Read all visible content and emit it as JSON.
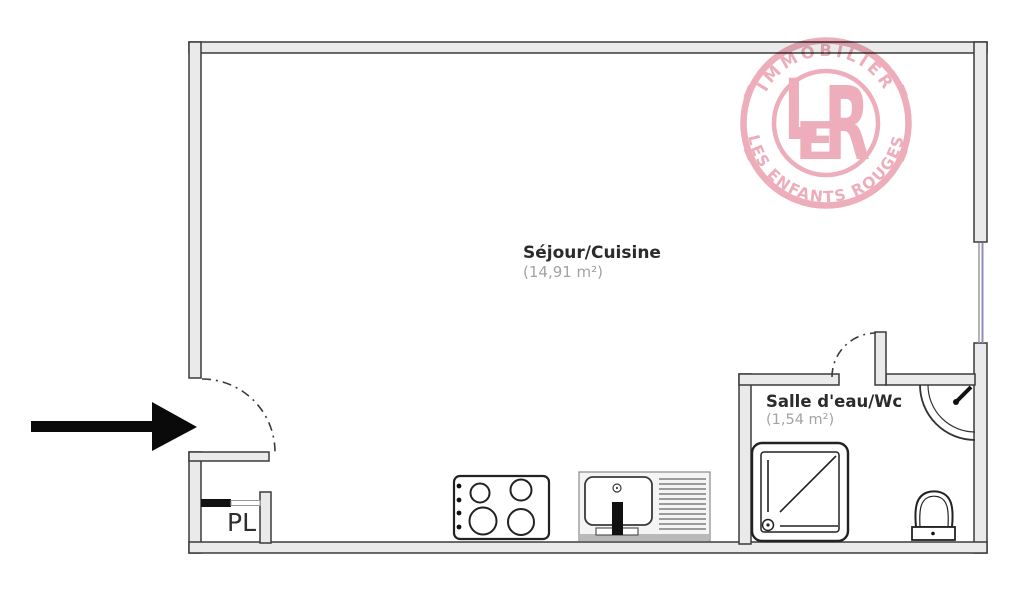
{
  "plan": {
    "rooms": {
      "sejour_cuisine": {
        "name": "Séjour/Cuisine",
        "area": "(14,91 m²)"
      },
      "salle_deau_wc": {
        "name": "Salle d'eau/Wc",
        "area": "(1,54 m²)"
      },
      "placard": {
        "label": "PL"
      }
    },
    "fixtures": [
      "entrance-arrow",
      "entrance-door-arc",
      "closet-sliding-door",
      "stove-4-burners",
      "kitchen-sink-with-drainboard",
      "window",
      "bathroom-door-arc",
      "shower-tray",
      "corner-washbasin",
      "toilet"
    ],
    "colors": {
      "wall_fill": "#eaeaea",
      "wall_line": "#3b3b3b",
      "window_blue": "#8d8dbf",
      "fixture_line": "#222222",
      "label_dark": "#2b2b2b",
      "label_gray": "#a3a3a3",
      "arrow_black": "#0a0a0a"
    }
  },
  "logo": {
    "arc_top": "IMMOBILIER",
    "arc_bottom": "LES ENFANTS ROUGES",
    "monogram": {
      "l": "L",
      "e": "E",
      "r": "R"
    },
    "color": "#eca6b4"
  }
}
